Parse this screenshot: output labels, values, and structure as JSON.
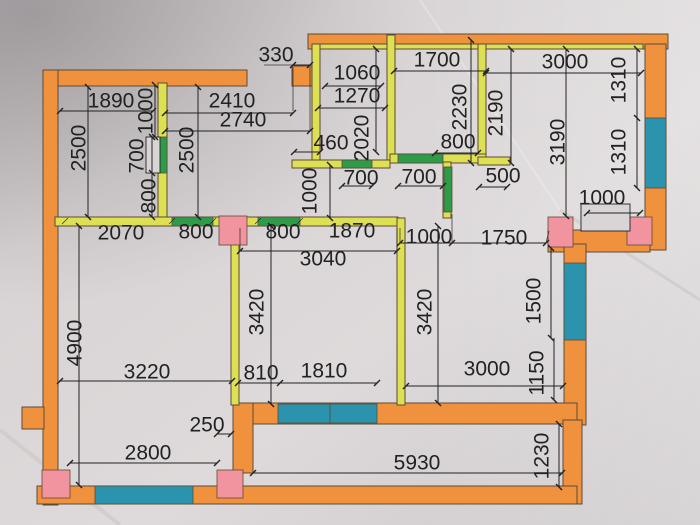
{
  "plan": {
    "kind": "hand-drawn apartment floor plan photo",
    "units_implied": "mm"
  },
  "colors": {
    "orange": "#ef913d",
    "yellow": "#dde052",
    "green": "#2e9b49",
    "teal": "#2b93ae",
    "pink": "#f2949f",
    "paper": "#d9d5d6",
    "ink": "#222222",
    "outline": "#5d4a35"
  },
  "legend": {
    "orange_walls": "exterior walls",
    "yellow_walls": "interior walls",
    "green_segments": "door openings",
    "teal_segments": "windows",
    "pink_blocks": "columns"
  },
  "dims": {
    "top_330": {
      "text": "330"
    },
    "r1_w1890": {
      "text": "1890"
    },
    "r2_w2410": {
      "text": "2410"
    },
    "r2_w2740": {
      "text": "2740"
    },
    "b1_1060": {
      "text": "1060"
    },
    "b1_1270": {
      "text": "1270"
    },
    "b2_1700": {
      "text": "1700"
    },
    "tr_3000": {
      "text": "3000"
    },
    "c_460": {
      "text": "460"
    },
    "b2_800": {
      "text": "800"
    },
    "b1_700": {
      "text": "700"
    },
    "b2_700": {
      "text": "700"
    },
    "c_500": {
      "text": "500"
    },
    "mw_2070": {
      "text": "2070"
    },
    "mw_800a": {
      "text": "800"
    },
    "mw_800b": {
      "text": "800"
    },
    "mw_1870": {
      "text": "1870"
    },
    "mw_1000": {
      "text": "1000"
    },
    "mw_1750": {
      "text": "1750"
    },
    "notch_1000": {
      "text": "1000"
    },
    "k_3040": {
      "text": "3040"
    },
    "lr_3220": {
      "text": "3220"
    },
    "k_810": {
      "text": "810"
    },
    "k_1810": {
      "text": "1810"
    },
    "br_3000": {
      "text": "3000"
    },
    "lr_250": {
      "text": "250"
    },
    "lr_2800": {
      "text": "2800"
    },
    "bal_5930": {
      "text": "5930"
    },
    "r1_1000": {
      "text": "1000"
    },
    "r1_2500": {
      "text": "2500"
    },
    "r1_700": {
      "text": "700"
    },
    "r1_800": {
      "text": "800"
    },
    "r2_2500": {
      "text": "2500"
    },
    "b1_2020": {
      "text": "2020"
    },
    "b2_2230": {
      "text": "2230"
    },
    "h_2190": {
      "text": "2190"
    },
    "c_1000": {
      "text": "1000"
    },
    "tr_3190": {
      "text": "3190"
    },
    "tr_1310a": {
      "text": "1310"
    },
    "tr_1310b": {
      "text": "1310"
    },
    "k_3420": {
      "text": "3420"
    },
    "lv_3420": {
      "text": "3420"
    },
    "lr_4900": {
      "text": "4900"
    },
    "br_1500": {
      "text": "1500"
    },
    "br_1150": {
      "text": "1150"
    },
    "bal_1230": {
      "text": "1230"
    }
  }
}
